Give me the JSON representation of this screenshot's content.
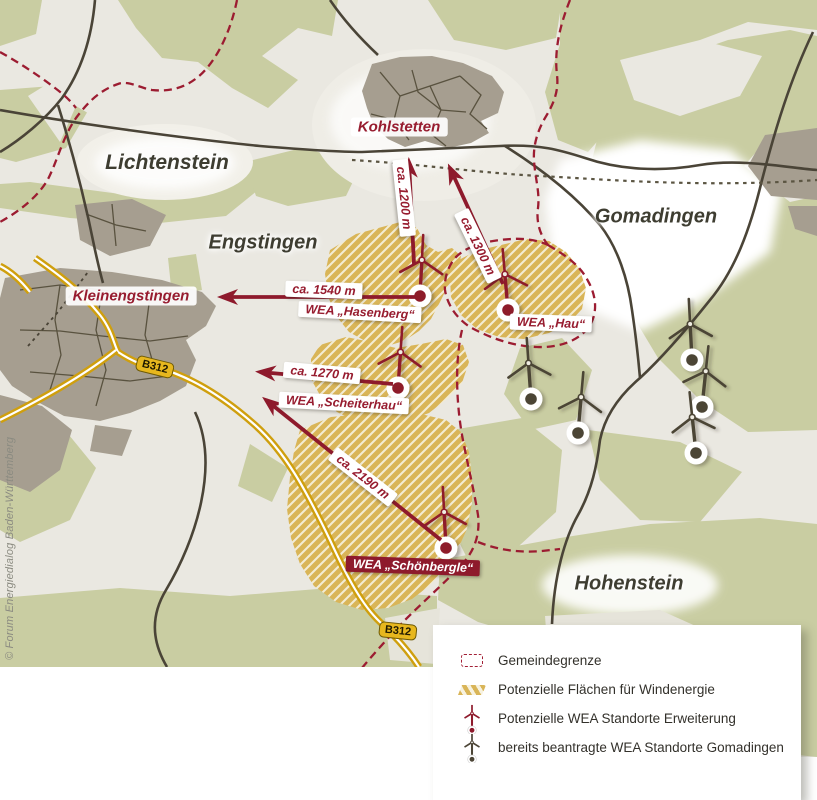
{
  "map": {
    "municipalities": [
      {
        "name": "Lichtenstein"
      },
      {
        "name": "Engstingen"
      },
      {
        "name": "Gomadingen"
      },
      {
        "name": "Hohenstein"
      }
    ],
    "villages": [
      {
        "name": "Kohlstetten"
      },
      {
        "name": "Kleinengstingen"
      }
    ],
    "wea_sites": [
      {
        "label": "WEA „Hasenberg“"
      },
      {
        "label": "WEA „Hau“"
      },
      {
        "label": "WEA „Scheiterhau“"
      },
      {
        "label": "WEA „Schönbergle“"
      }
    ],
    "distances": [
      {
        "label": "ca. 1200 m"
      },
      {
        "label": "ca. 1300 m"
      },
      {
        "label": "ca. 1540 m"
      },
      {
        "label": "ca. 1270 m"
      },
      {
        "label": "ca. 2190 m"
      }
    ],
    "road_badges": [
      {
        "label": "B312"
      },
      {
        "label": "B312"
      }
    ],
    "copyright": "© Forum Energiedialog Baden-Württemberg"
  },
  "legend": {
    "items": [
      {
        "icon": "boundary-dashed",
        "label": "Gemeindegrenze"
      },
      {
        "icon": "hatched-area",
        "label": "Potenzielle Flächen für Windenergie"
      },
      {
        "icon": "turbine-red",
        "label": "Potenzielle WEA Standorte Erweiterung"
      },
      {
        "icon": "turbine-gray",
        "label": "bereits beantragte WEA Standorte Gomadingen"
      }
    ]
  },
  "colors": {
    "accent_red": "#971c2f",
    "forest_green": "#c9cda2",
    "hatch_gold": "#d9b558",
    "road_yellow": "#d5a713",
    "turbine_gray": "#4c4536"
  }
}
